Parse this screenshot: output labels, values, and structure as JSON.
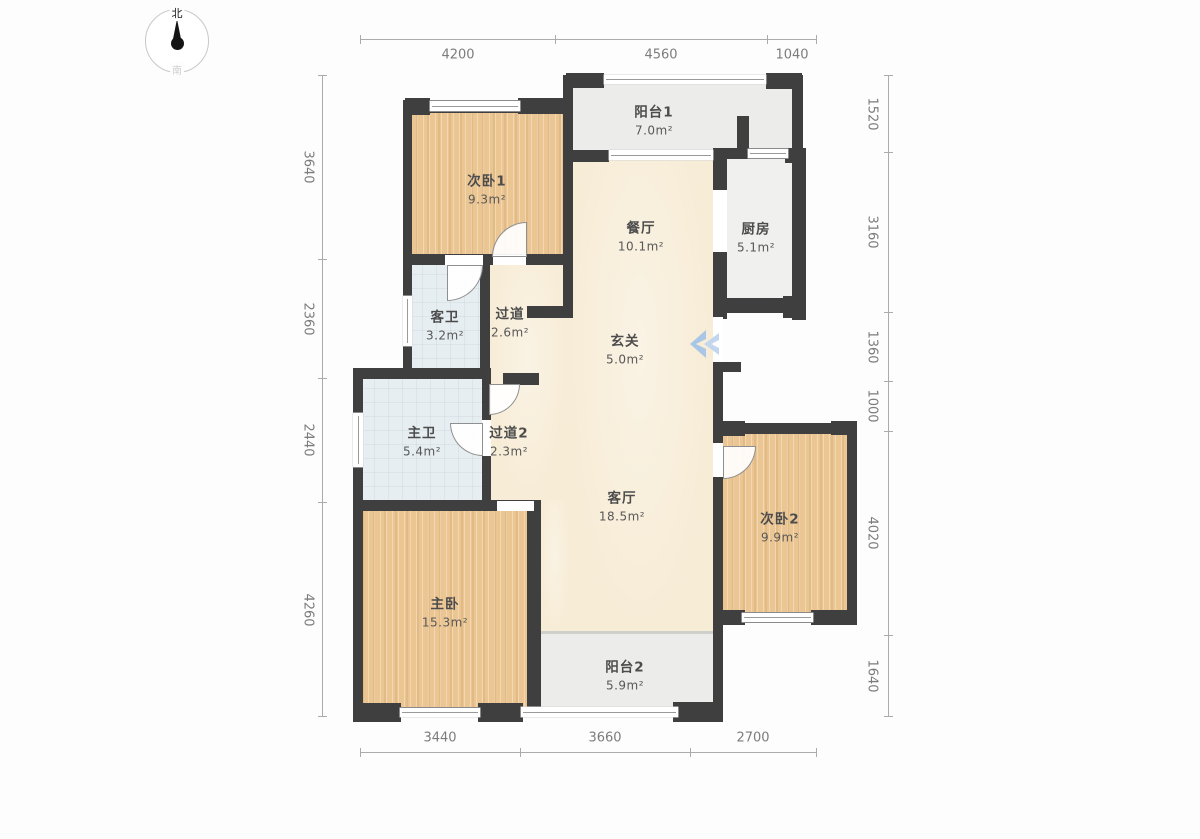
{
  "compass": {
    "north": "北",
    "south": "南"
  },
  "dimensions": {
    "top": [
      "4200",
      "4560",
      "1040"
    ],
    "bottom": [
      "3440",
      "3660",
      "2700"
    ],
    "left": [
      "3640",
      "2360",
      "2440",
      "4260"
    ],
    "right": [
      "1520",
      "3160",
      "1360",
      "1000",
      "4020",
      "1640"
    ]
  },
  "rooms": {
    "bedroom1": {
      "name": "次卧1",
      "area": "9.3m²"
    },
    "balcony1": {
      "name": "阳台1",
      "area": "7.0m²"
    },
    "dining": {
      "name": "餐厅",
      "area": "10.1m²"
    },
    "kitchen": {
      "name": "厨房",
      "area": "5.1m²"
    },
    "guest_bath": {
      "name": "客卫",
      "area": "3.2m²"
    },
    "hallway1": {
      "name": "过道",
      "area": "2.6m²"
    },
    "foyer": {
      "name": "玄关",
      "area": "5.0m²"
    },
    "master_bath": {
      "name": "主卫",
      "area": "5.4m²"
    },
    "hallway2": {
      "name": "过道2",
      "area": "2.3m²"
    },
    "living": {
      "name": "客厅",
      "area": "18.5m²"
    },
    "bedroom2": {
      "name": "次卧2",
      "area": "9.9m²"
    },
    "master_bedroom": {
      "name": "主卧",
      "area": "15.3m²"
    },
    "balcony2": {
      "name": "阳台2",
      "area": "5.9m²"
    }
  },
  "colors": {
    "wall": "#3f3f3f",
    "wood_floor": "#ecc692",
    "living_floor": "#f7ecd6",
    "balcony_floor": "#ececea",
    "bath_floor": "#e6eef1",
    "entry_arrow": "#a9c6e6",
    "dimension_text": "#7c7c7c"
  }
}
